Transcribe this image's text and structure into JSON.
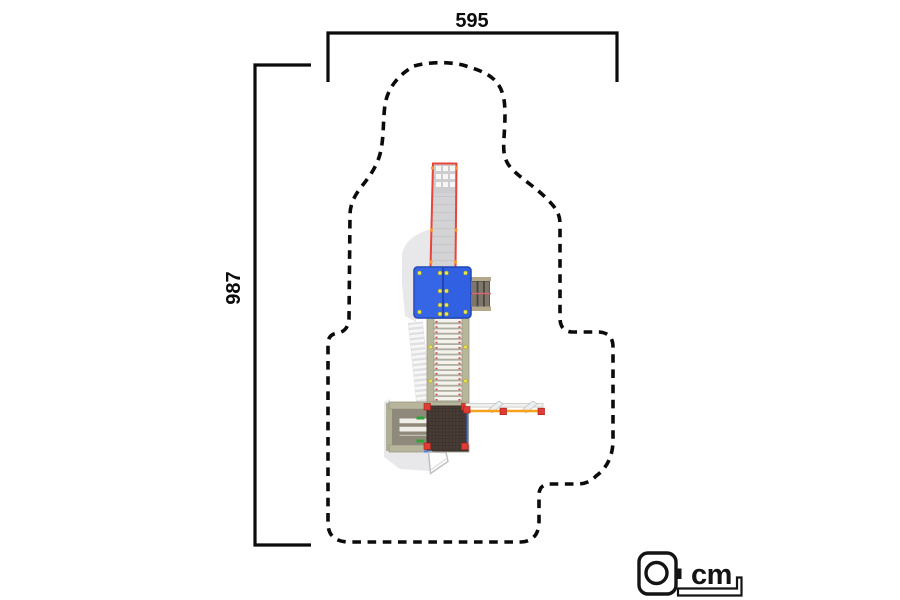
{
  "drawing": {
    "type": "playground equipment top view dimension drawing",
    "top_dimension_label": "595",
    "left_dimension_label": "987",
    "unit_label": "cm",
    "unit_icon": "tape-measure-icon"
  },
  "equipment_parts": [
    "slide",
    "slide-exit-perforated-pad",
    "roof-panel",
    "side-steps",
    "rung-bridge",
    "rubber-platform",
    "access-steps",
    "balance-bar",
    "gate-panel",
    "safety-zone-outline"
  ],
  "colors": {
    "line_black": "#0b0b0b",
    "roof_blue": "#3160e2",
    "roof_edge_blue": "#2247b2",
    "bolt_yellow": "#e9e44c",
    "slide_rail_red": "#e8443b",
    "post_red": "#e23b35",
    "bar_orange": "#f6a21d",
    "clip_green": "#2fa23c",
    "frame_tan": "#b7b69c",
    "rung_white": "#f3f2ec",
    "platform_brown": "#483c36",
    "step_brown": "#7d766b",
    "shadow_grey": "#e4e4e6",
    "slide_grey": "#d3d3d5"
  }
}
